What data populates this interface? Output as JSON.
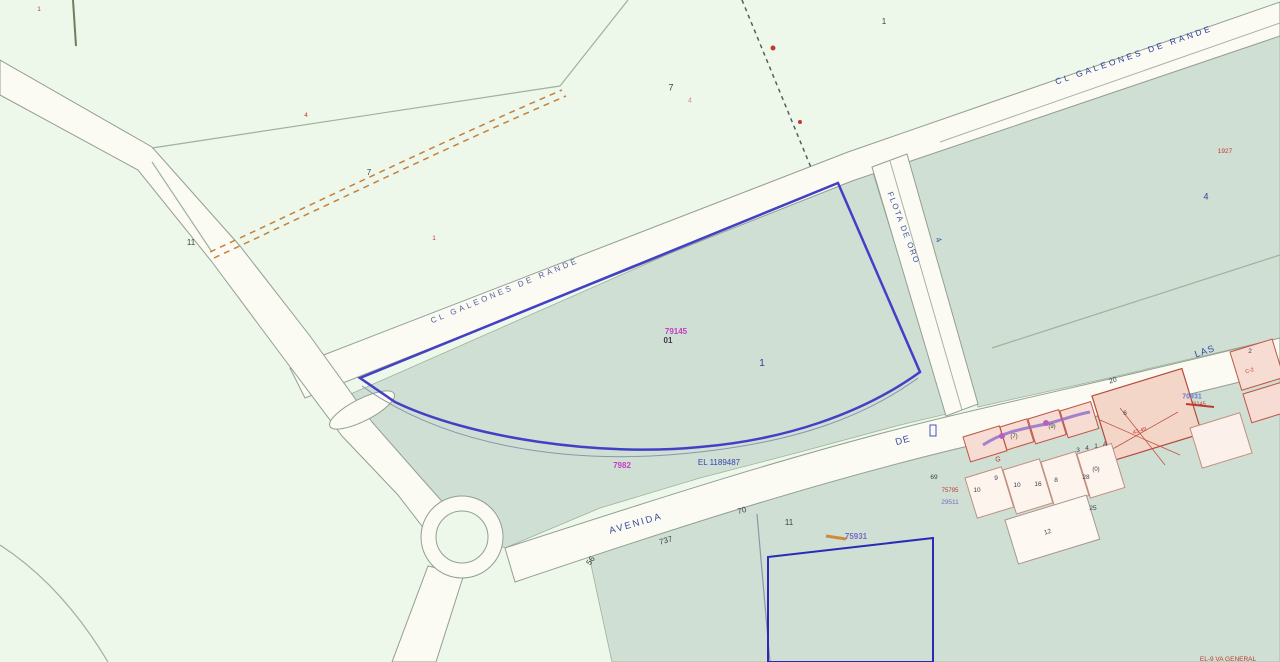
{
  "map": {
    "kind": "cadastral parcel map",
    "selected_parcel": {
      "number": "1",
      "code": "79145 01",
      "outline_color": "#4340c6"
    },
    "streets": [
      "CL GALEONES DE RANDE",
      "FLOTA DE ORO",
      "AVENIDA",
      "DE",
      "LAS"
    ]
  },
  "colors": {
    "background": "#edf7ea",
    "parcel_teal": "#cfdfd3",
    "road_fill": "#fbfbf3",
    "road_edge": "#939f92",
    "field_line": "#9db39a",
    "parcel_blue": "#4340c6",
    "rect_parcel_blue": "#2a2ab8",
    "street_text": "#3a4a9e",
    "magenta": "#c43fc4",
    "red": "#c03a30",
    "orange_track": "#c5803d",
    "building_fill": "#f6dcd2",
    "building_stroke": "#c05545",
    "purple_scribble": "#8e6bc8"
  },
  "labels": [
    {
      "name": "street-label-galeones-west",
      "text": "CL  GALEONES  DE  RANDE",
      "x": 505,
      "y": 291,
      "rot": -22.5,
      "size": 8,
      "ls": 3,
      "color": "#54609f"
    },
    {
      "name": "street-label-galeones-east",
      "text": "CL  GALEONES  DE  RANDE",
      "x": 1134,
      "y": 55,
      "rot": -19,
      "size": 8.5,
      "ls": 3,
      "color": "#2c3da0"
    },
    {
      "name": "street-label-flota-de-oro",
      "text": "FLOTA DE ORO",
      "x": 903,
      "y": 228,
      "rot": 69,
      "size": 8,
      "ls": 1.5,
      "color": "#44549e"
    },
    {
      "name": "street-label-avenida",
      "text": "AVENIDA",
      "x": 636,
      "y": 524,
      "rot": -16,
      "size": 9.5,
      "ls": 2,
      "color": "#3a4a9e"
    },
    {
      "name": "street-label-de",
      "text": "DE",
      "x": 903,
      "y": 441,
      "rot": -16,
      "size": 9.5,
      "ls": 1,
      "color": "#3a4a9e"
    },
    {
      "name": "street-label-las",
      "text": "LAS",
      "x": 1205,
      "y": 352,
      "rot": -19,
      "size": 9.5,
      "ls": 1,
      "color": "#3a4a9e"
    },
    {
      "name": "road-number",
      "text": "737",
      "x": 666,
      "y": 541,
      "rot": -16,
      "size": 8,
      "color": "#3c4348"
    },
    {
      "name": "road-number",
      "text": "70",
      "x": 742,
      "y": 511,
      "rot": -16,
      "size": 8,
      "color": "#3c4348"
    },
    {
      "name": "road-number",
      "text": "56",
      "x": 591,
      "y": 561,
      "rot": -55,
      "size": 8,
      "color": "#3c4348"
    },
    {
      "name": "parcel-number",
      "text": "11",
      "x": 789,
      "y": 523,
      "rot": 0,
      "size": 8,
      "color": "#3c4348"
    },
    {
      "name": "road-number",
      "text": "4",
      "x": 938,
      "y": 240,
      "rot": 65,
      "size": 8,
      "color": "#44549e"
    },
    {
      "name": "parcel-number",
      "text": "7",
      "x": 671,
      "y": 88,
      "rot": 0,
      "size": 9,
      "color": "#3c4348"
    },
    {
      "name": "parcel-number",
      "text": "7",
      "x": 369,
      "y": 173,
      "rot": 0,
      "size": 8,
      "color": "#3c4348"
    },
    {
      "name": "parcel-number",
      "text": "11",
      "x": 191,
      "y": 243,
      "rot": 0,
      "size": 8,
      "color": "#3c4348"
    },
    {
      "name": "parcel-number",
      "text": "1",
      "x": 884,
      "y": 22,
      "rot": 0,
      "size": 8,
      "color": "#3c4348"
    },
    {
      "name": "parcel-number",
      "text": "4",
      "x": 1206,
      "y": 197,
      "rot": 0,
      "size": 9,
      "color": "#2c3da0"
    },
    {
      "name": "selected-parcel-number",
      "text": "1",
      "x": 762,
      "y": 364,
      "rot": 0,
      "size": 10,
      "color": "#2c3da0"
    },
    {
      "name": "parcel-code-magenta",
      "text": "79145",
      "x": 676,
      "y": 332,
      "rot": 0,
      "size": 8,
      "w": 700,
      "color": "#c43fc4"
    },
    {
      "name": "parcel-code-dark",
      "text": "01",
      "x": 668,
      "y": 341,
      "rot": 0,
      "size": 8,
      "w": 700,
      "color": "#3c3744"
    },
    {
      "name": "parcel-code-magenta",
      "text": "7982",
      "x": 622,
      "y": 466,
      "rot": 0,
      "size": 8,
      "w": 700,
      "color": "#c43fc4"
    },
    {
      "name": "parcel-ref-blue",
      "text": "EL 1189487",
      "x": 719,
      "y": 463,
      "rot": 0,
      "size": 8,
      "color": "#3444b0"
    },
    {
      "name": "parcel-code-purple",
      "text": "75931",
      "x": 856,
      "y": 537,
      "rot": 0,
      "size": 8,
      "w": 700,
      "color": "#7a68c8"
    },
    {
      "name": "parcel-number",
      "text": "69",
      "x": 934,
      "y": 478,
      "rot": 0,
      "size": 6.5,
      "color": "#3c4348"
    },
    {
      "name": "parcel-code-red",
      "text": "75795",
      "x": 950,
      "y": 491,
      "rot": 0,
      "size": 6,
      "color": "#c03a30"
    },
    {
      "name": "parcel-code-purple",
      "text": "29511",
      "x": 950,
      "y": 503,
      "rot": 0,
      "size": 6.5,
      "color": "#7a68c8"
    },
    {
      "name": "house-number",
      "text": "10",
      "x": 977,
      "y": 491,
      "rot": 0,
      "size": 6.5,
      "color": "#3c4348"
    },
    {
      "name": "house-number",
      "text": "9",
      "x": 996,
      "y": 479,
      "rot": 0,
      "size": 6.5,
      "color": "#3c4348"
    },
    {
      "name": "house-number",
      "text": "10",
      "x": 1017,
      "y": 486,
      "rot": 0,
      "size": 6.5,
      "color": "#3c4348"
    },
    {
      "name": "house-number",
      "text": "16",
      "x": 1038,
      "y": 485,
      "rot": 0,
      "size": 6.5,
      "color": "#3c4348"
    },
    {
      "name": "house-number",
      "text": "8",
      "x": 1056,
      "y": 481,
      "rot": 0,
      "size": 6.5,
      "color": "#3c4348"
    },
    {
      "name": "house-number",
      "text": "28",
      "x": 1086,
      "y": 478,
      "rot": 0,
      "size": 6.5,
      "color": "#3c4348"
    },
    {
      "name": "house-number",
      "text": "(0)",
      "x": 1096,
      "y": 470,
      "rot": 0,
      "size": 6,
      "color": "#3c4348"
    },
    {
      "name": "house-number",
      "text": "3",
      "x": 1078,
      "y": 451,
      "rot": 0,
      "size": 6.5,
      "color": "#3c4348"
    },
    {
      "name": "house-number",
      "text": "4",
      "x": 1087,
      "y": 449,
      "rot": 0,
      "size": 6.5,
      "color": "#3c4348"
    },
    {
      "name": "house-number",
      "text": "1",
      "x": 1096,
      "y": 447,
      "rot": 0,
      "size": 6.5,
      "color": "#3c4348"
    },
    {
      "name": "house-number",
      "text": "A",
      "x": 1105,
      "y": 445,
      "rot": 0,
      "size": 6.5,
      "color": "#3c4348"
    },
    {
      "name": "house-number",
      "text": "(9)",
      "x": 1052,
      "y": 427,
      "rot": 0,
      "size": 6,
      "color": "#3c4348"
    },
    {
      "name": "house-number",
      "text": "(7)",
      "x": 1014,
      "y": 437,
      "rot": 0,
      "size": 6,
      "color": "#3c4348"
    },
    {
      "name": "house-letter",
      "text": "G",
      "x": 998,
      "y": 460,
      "rot": 0,
      "size": 7,
      "color": "#c03a30"
    },
    {
      "name": "house-number",
      "text": "6",
      "x": 1125,
      "y": 414,
      "rot": 0,
      "size": 6.5,
      "color": "#3c4348"
    },
    {
      "name": "road-number",
      "text": "20",
      "x": 1113,
      "y": 381,
      "rot": -18,
      "size": 7,
      "color": "#3c4348"
    },
    {
      "name": "parcel-code-blue",
      "text": "70931",
      "x": 1192,
      "y": 397,
      "rot": 0,
      "size": 7,
      "w": 700,
      "color": "#6a7ac8"
    },
    {
      "name": "parcel-code-red",
      "text": "79145",
      "x": 1198,
      "y": 405,
      "rot": 0,
      "size": 5.5,
      "color": "#c03a30"
    },
    {
      "name": "parcel-code-red",
      "text": "1927",
      "x": 1225,
      "y": 152,
      "rot": 0,
      "size": 6.5,
      "color": "#c03a30"
    },
    {
      "name": "parcel-mark-red",
      "text": "4",
      "x": 306,
      "y": 116,
      "rot": 0,
      "size": 6.5,
      "color": "#c03a30"
    },
    {
      "name": "parcel-mark-red",
      "text": "1",
      "x": 434,
      "y": 239,
      "rot": 0,
      "size": 6.5,
      "color": "#c03a30"
    },
    {
      "name": "parcel-mark-red",
      "text": "1",
      "x": 39,
      "y": 10,
      "rot": 0,
      "size": 6.5,
      "color": "#c03a30"
    },
    {
      "name": "parcel-mark-red",
      "text": "4",
      "x": 690,
      "y": 101,
      "rot": 0,
      "size": 7,
      "color": "#d98a7c"
    },
    {
      "name": "edge-text-red",
      "text": "EL-9 VA GENERAL",
      "x": 1228,
      "y": 660,
      "rot": 0,
      "size": 6.5,
      "color": "#c03a30"
    },
    {
      "name": "house-number",
      "text": "2",
      "x": 1250,
      "y": 352,
      "rot": 0,
      "size": 6.5,
      "color": "#3c4348"
    },
    {
      "name": "house-number",
      "text": "12",
      "x": 1048,
      "y": 533,
      "rot": -17,
      "size": 6.5,
      "color": "#3c4348"
    },
    {
      "name": "house-number",
      "text": "25",
      "x": 1093,
      "y": 509,
      "rot": 0,
      "size": 6.5,
      "color": "#3c4348"
    },
    {
      "name": "building-text-red",
      "text": "43-49",
      "x": 1140,
      "y": 432,
      "rot": -17,
      "size": 5.5,
      "color": "#c03a30"
    },
    {
      "name": "building-text-red",
      "text": "C-2",
      "x": 1250,
      "y": 372,
      "rot": -17,
      "size": 5.5,
      "color": "#c03a30"
    }
  ]
}
